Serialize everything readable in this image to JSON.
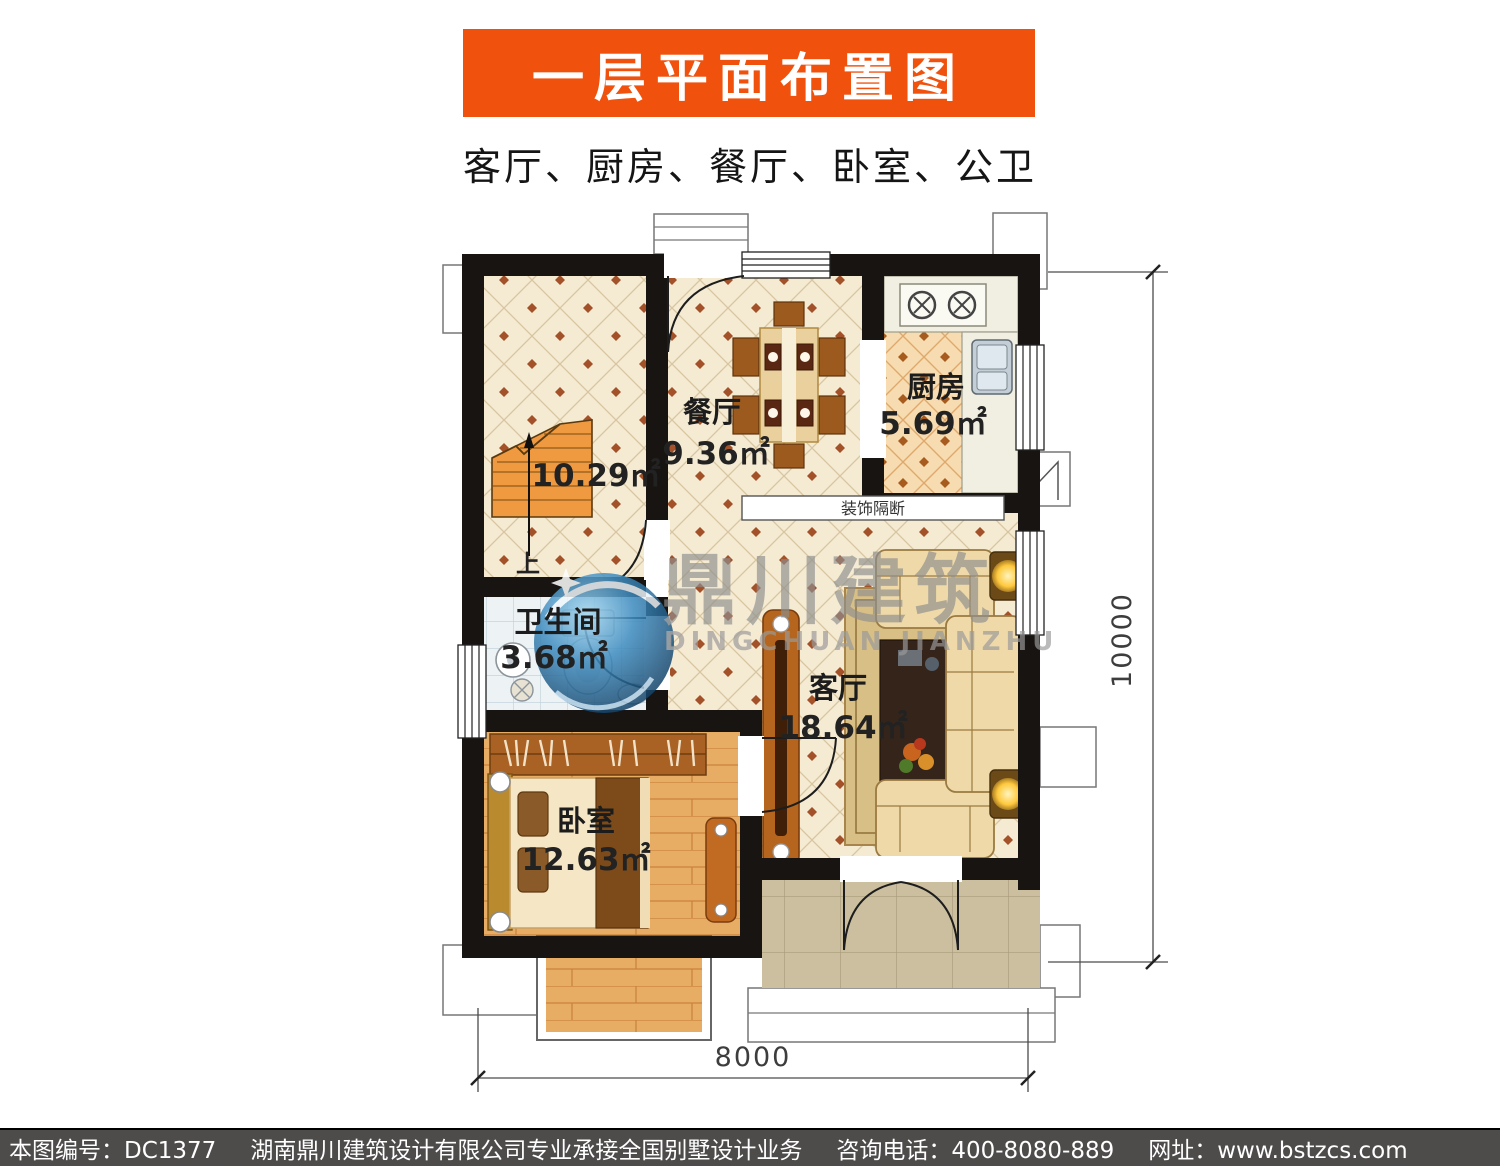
{
  "header": {
    "title": "一层平面布置图",
    "subtitle": "客厅、厨房、餐厅、卧室、公卫"
  },
  "colors": {
    "banner_bg": "#f0520d",
    "footer_bg": "#4e4b4b",
    "wall": "#181411",
    "stairs_fill": "#ef9a41",
    "watermark_blue": "#3e8cc0",
    "cream_floor": "#f5ead2",
    "kitchen_floor": "#f6dcb0",
    "wood_floor": "#e7ad64",
    "porch_floor": "#cbbf9f"
  },
  "rooms": {
    "stairwell": {
      "area": "10.29㎡",
      "up": "上"
    },
    "dining": {
      "name": "餐厅",
      "area": "9.36㎡"
    },
    "kitchen": {
      "name": "厨房",
      "area": "5.69㎡"
    },
    "bathroom": {
      "name": "卫生间",
      "area": "3.68㎡"
    },
    "living": {
      "name": "客厅",
      "area": "18.64㎡"
    },
    "bedroom": {
      "name": "卧室",
      "area": "12.63㎡"
    },
    "partition_label": "装饰隔断"
  },
  "watermark": {
    "cn": "鼎川建筑",
    "en": "DINGCHUAN JIANZHU"
  },
  "dimensions": {
    "right": "10000",
    "bottom": "8000"
  },
  "footer": {
    "items": [
      "本图编号：DC1377",
      "湖南鼎川建筑设计有限公司专业承接全国别墅设计业务",
      "咨询电话：400-8080-889",
      "网址：www.bstzcs.com"
    ]
  }
}
